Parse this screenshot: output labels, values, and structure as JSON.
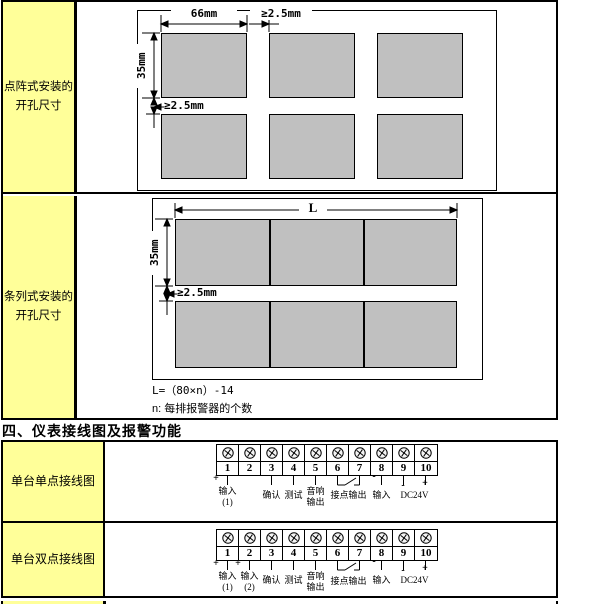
{
  "colors": {
    "label_bg": "#FFFF99",
    "panel_gray": "#C0C0C0",
    "border": "#000000"
  },
  "matrix_row": {
    "label_line1": "点阵式安装的",
    "label_line2": "开孔尺寸",
    "dim_width": "66mm",
    "dim_hgap": "≥2.5mm",
    "dim_height": "35mm",
    "dim_vgap": "≥2.5mm"
  },
  "strip_row": {
    "label_line1": "条列式安装的",
    "label_line2": "开孔尺寸",
    "dim_length": "L",
    "dim_height": "35mm",
    "dim_vgap": "≥2.5mm",
    "formula": "L=（80×n）-14",
    "formula_note": "n: 每排报警器的个数"
  },
  "section_header": "四、仪表接线图及报警功能",
  "wiring_single": {
    "label": "单台单点接线图",
    "terminals": [
      "1",
      "2",
      "3",
      "4",
      "5",
      "6",
      "7",
      "8",
      "9",
      "10"
    ],
    "plus": "+",
    "minus": "-",
    "t1_label": "输入",
    "t1_sub": "(1)",
    "t3_label": "确认",
    "t4_label": "测试",
    "t5_line1": "音响",
    "t5_line2": "输出",
    "relay_label": "接点输出",
    "t8_label": "输入",
    "dc_label": "DC24V"
  },
  "wiring_double": {
    "label": "单台双点接线图",
    "terminals": [
      "1",
      "2",
      "3",
      "4",
      "5",
      "6",
      "7",
      "8",
      "9",
      "10"
    ],
    "plus": "+",
    "minus": "-",
    "t1_label": "输入",
    "t1_sub": "(1)",
    "t2_label": "输入",
    "t2_sub": "(2)",
    "t3_label": "确认",
    "t4_label": "测试",
    "t5_line1": "音响",
    "t5_line2": "输出",
    "relay_label": "接点输出",
    "t8_label": "输入",
    "dc_label": "DC24V"
  }
}
